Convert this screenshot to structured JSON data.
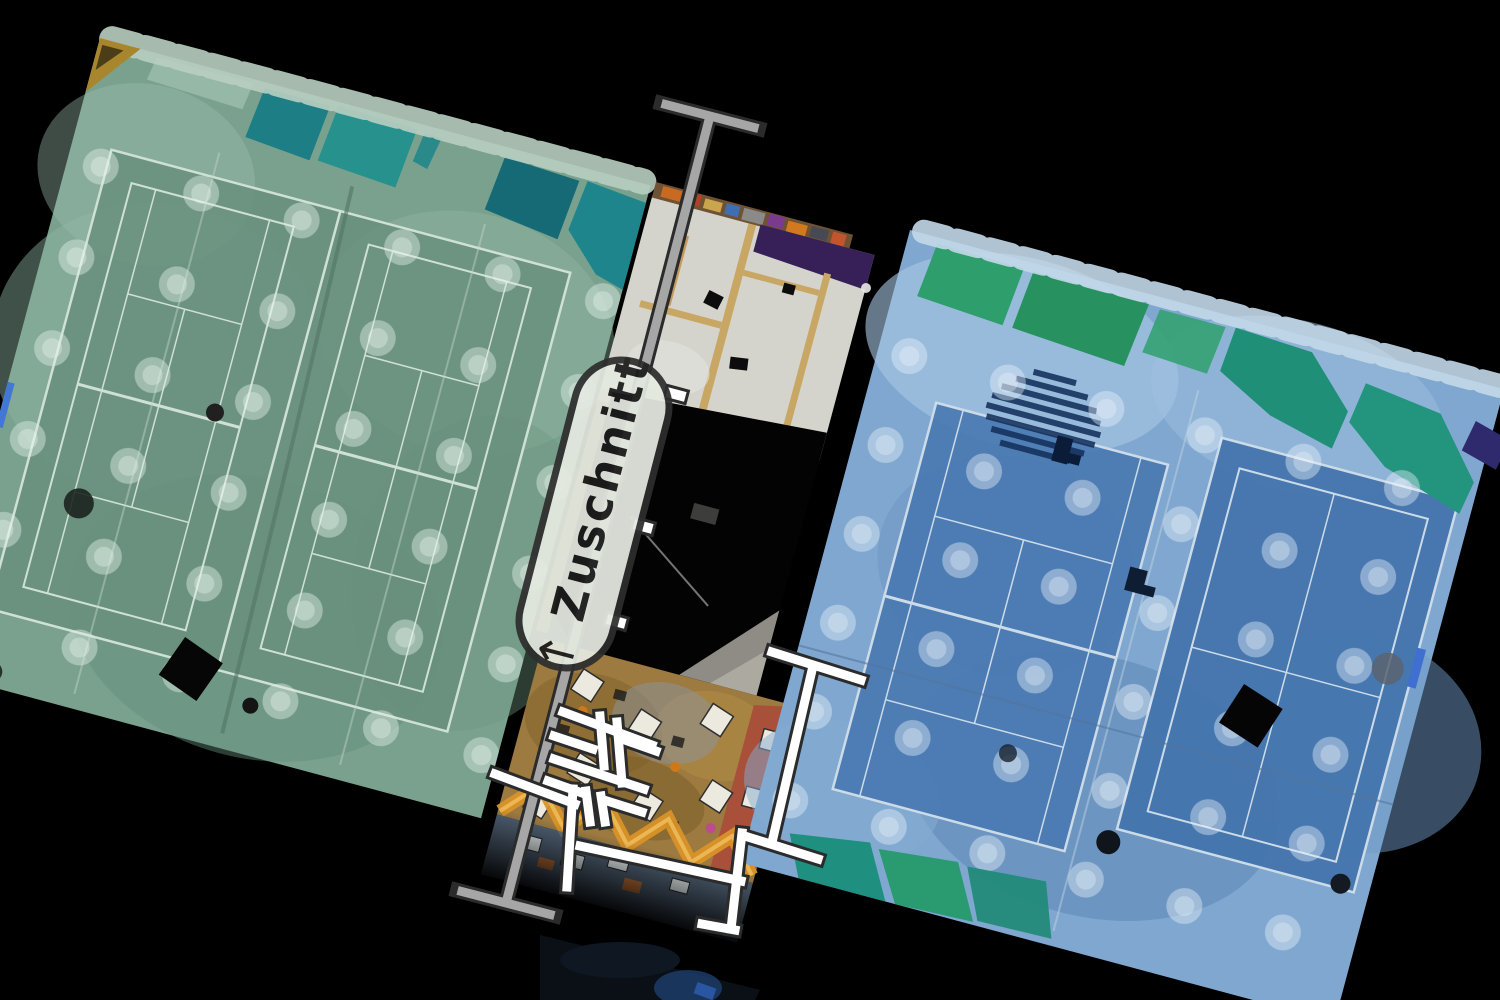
{
  "annotations": {
    "crop_label": {
      "arrow": "↑",
      "text": "Zuschnitt"
    },
    "section_line": {
      "x1": 710,
      "y1": 116,
      "x2": 506,
      "y2": 903,
      "cap_half": 50
    },
    "plan_segments": [
      [
        563,
        712,
        652,
        745
      ],
      [
        554,
        736,
        593,
        749
      ],
      [
        622,
        739,
        656,
        751
      ],
      [
        554,
        759,
        644,
        789
      ],
      [
        548,
        781,
        585,
        794
      ],
      [
        604,
        800,
        642,
        812
      ],
      [
        600,
        716,
        604,
        766
      ],
      [
        617,
        722,
        622,
        783
      ],
      [
        586,
        791,
        590,
        822
      ],
      [
        601,
        796,
        605,
        822
      ],
      [
        495,
        774,
        575,
        804
      ],
      [
        573,
        789,
        567,
        887
      ],
      [
        580,
        846,
        741,
        881
      ],
      [
        772,
        652,
        861,
        680
      ],
      [
        813,
        666,
        773,
        838
      ],
      [
        748,
        837,
        818,
        859
      ],
      [
        742,
        833,
        731,
        929
      ],
      [
        702,
        924,
        735,
        930
      ]
    ],
    "wall_markers": [
      [
        676,
        395
      ],
      [
        643,
        527
      ],
      [
        616,
        622
      ]
    ]
  },
  "colors": {
    "background": "#000000",
    "section_line": "#a6a6a6",
    "anno_outline": "#2b2b2b",
    "plan_line": "#ffffff",
    "label_fill": "#e5eae1",
    "label_border": "#2e2e2e",
    "label_text": "#1c1c1c",
    "hall_left_tint": "#7aa18e",
    "hall_left_court": "#688f7d",
    "hall_left_curtain": "#1d7e86",
    "hall_right_tint": "#7fa7cf",
    "hall_right_court": "#4a7ab2",
    "hall_right_curtain": "#2f9e6d",
    "clubhouse_floor": "#d4d4cd",
    "clubhouse_terrace": "#9c7a40",
    "terrace_zigzag": "#d99428"
  }
}
